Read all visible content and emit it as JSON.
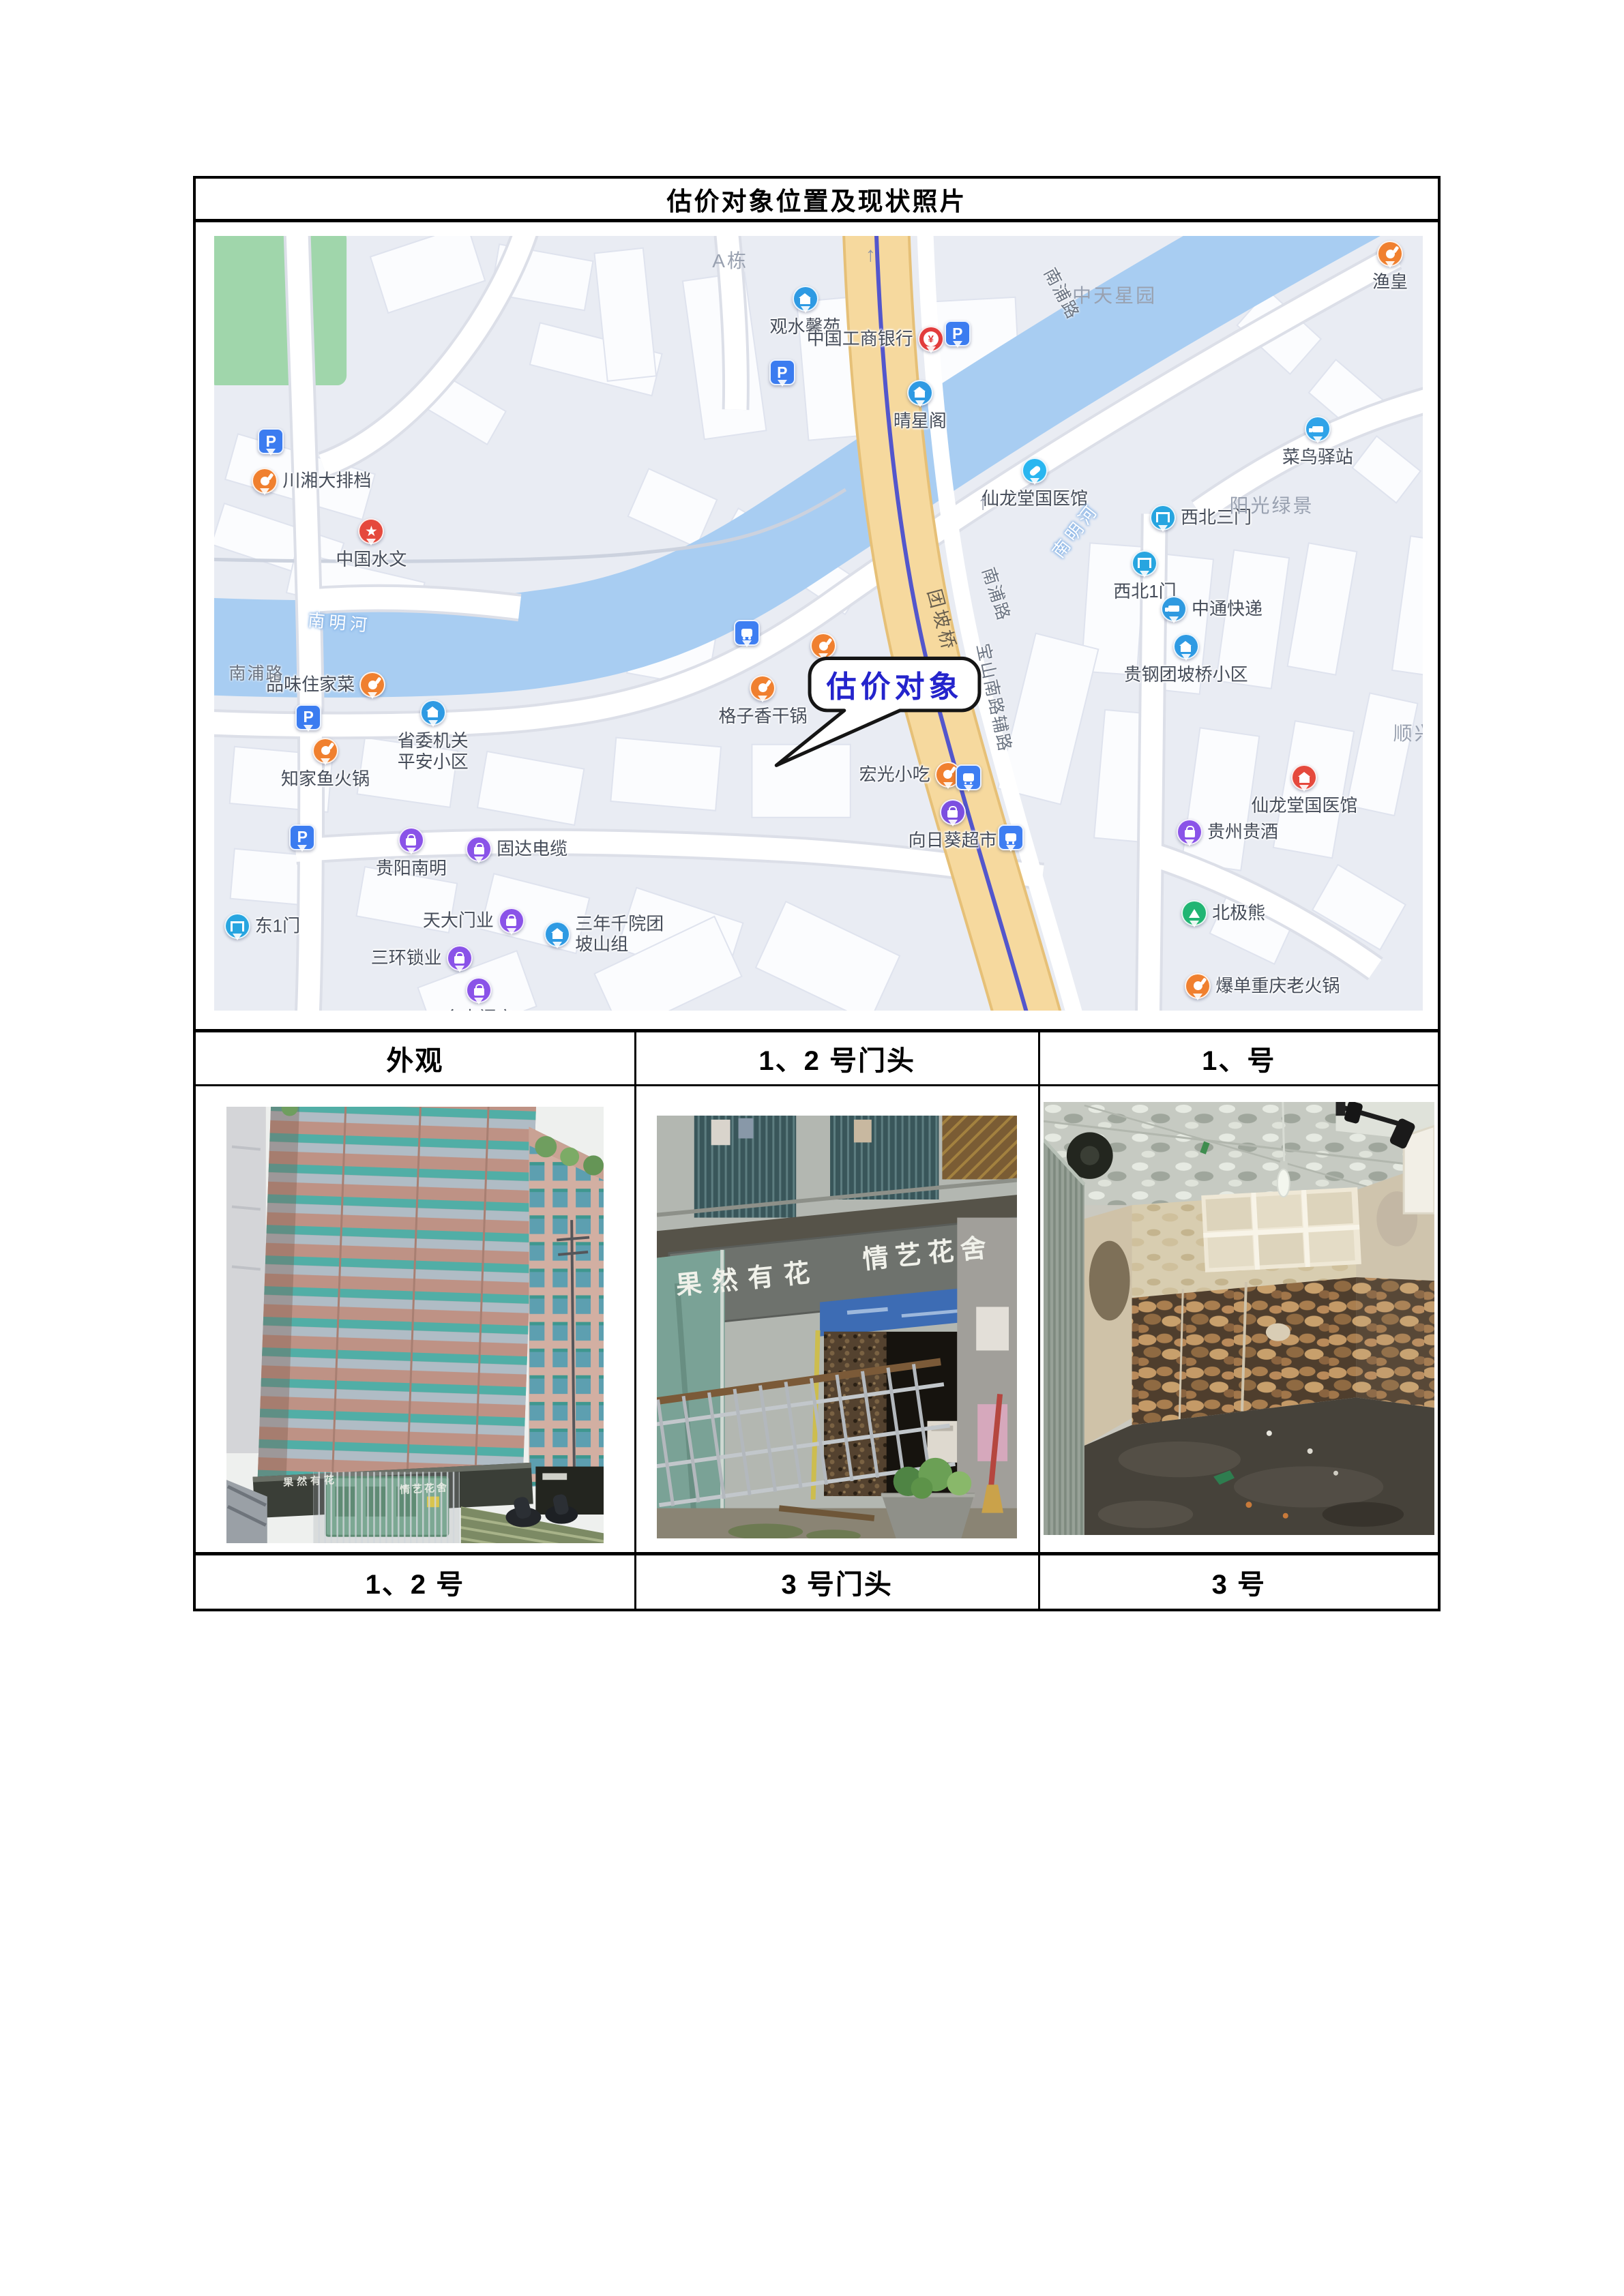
{
  "page": {
    "title": "估价对象位置及现状照片"
  },
  "table": {
    "header_row": [
      "外观",
      "1、2 号门头",
      "1、号"
    ],
    "footer_row": [
      "1、2 号",
      "3 号门头",
      "3 号"
    ]
  },
  "map": {
    "callout": {
      "text": "估价对象",
      "color": "#2424cc"
    },
    "colors": {
      "water": "#a8cdf2",
      "main_road": "#f6d99e",
      "park": "#a0d6ab",
      "background": "#e9ecf3",
      "metro_line": "#5356cc"
    },
    "area_labels": [
      {
        "text": "A栋",
        "x": 42.7,
        "y": 3.1
      },
      {
        "text": "中天星园",
        "x": 74.5,
        "y": 7.6
      },
      {
        "text": "阳光绿景",
        "x": 87.5,
        "y": 34.7
      },
      {
        "text": "顺兴",
        "x": 99.3,
        "y": 64.1
      }
    ],
    "road_labels": [
      {
        "text": "南浦路",
        "x": 3.5,
        "y": 56.3,
        "rot": 0,
        "style": "road"
      },
      {
        "text": "南浦路",
        "x": 70.2,
        "y": 7.4,
        "rot": 62,
        "style": "road"
      },
      {
        "text": "南浦路",
        "x": 64.8,
        "y": 46.2,
        "rot": 72,
        "style": "road"
      },
      {
        "text": "团坡桥",
        "x": 60.3,
        "y": 49.6,
        "rot": 75,
        "style": "main"
      },
      {
        "text": "宝山南路辅路",
        "x": 64.6,
        "y": 59.6,
        "rot": 78,
        "style": "road"
      },
      {
        "text": "南明河",
        "x": 10.4,
        "y": 49.8,
        "rot": 5,
        "style": "water"
      },
      {
        "text": "南明河",
        "x": 71.2,
        "y": 37.9,
        "rot": -52,
        "style": "water"
      }
    ],
    "arrows": [
      {
        "glyph": "↑",
        "x": 54.3,
        "y": 2.5,
        "rot": 0
      },
      {
        "glyph": "↑",
        "x": 63.6,
        "y": 34.5,
        "rot": 0
      },
      {
        "glyph": "↑",
        "x": 60.8,
        "y": 57.5,
        "rot": 180
      }
    ],
    "pois": [
      {
        "label": "",
        "icon": "parking",
        "color": "#3b7cf0",
        "x": 4.7,
        "y": 26.7,
        "lp": "r"
      },
      {
        "label": "川湘大排档",
        "icon": "food",
        "color": "#f0802f",
        "x": 4.2,
        "y": 31.8,
        "lp": "r"
      },
      {
        "label": "中国水文",
        "icon": "star",
        "color": "#e5493d",
        "x": 13.0,
        "y": 38.3,
        "lp": "b"
      },
      {
        "label": "品味住家菜",
        "icon": "food",
        "color": "#f0802f",
        "x": 13.1,
        "y": 58.1,
        "lp": "l"
      },
      {
        "label": "",
        "icon": "parking",
        "color": "#3b7cf0",
        "x": 7.8,
        "y": 62.3,
        "lp": "b"
      },
      {
        "label": "知家鱼火锅",
        "icon": "food",
        "color": "#f0802f",
        "x": 9.2,
        "y": 66.6,
        "lp": "b"
      },
      {
        "label": "省委机关\n平安小区",
        "icon": "building",
        "color": "#2e9ae3",
        "x": 18.1,
        "y": 61.7,
        "lp": "b"
      },
      {
        "label": "",
        "icon": "parking",
        "color": "#3b7cf0",
        "x": 7.3,
        "y": 77.8,
        "lp": "b"
      },
      {
        "label": "贵阳南明",
        "icon": "shop",
        "color": "#8a53e8",
        "x": 16.3,
        "y": 78.2,
        "lp": "b"
      },
      {
        "label": "固达电缆",
        "icon": "shop",
        "color": "#8a53e8",
        "x": 21.9,
        "y": 79.3,
        "lp": "r"
      },
      {
        "label": "东1门",
        "icon": "gate",
        "color": "#27a5e0",
        "x": 1.9,
        "y": 89.3,
        "lp": "r"
      },
      {
        "label": "天大门业",
        "icon": "shop",
        "color": "#8a53e8",
        "x": 24.6,
        "y": 88.6,
        "lp": "l"
      },
      {
        "label": "三环锁业",
        "icon": "shop",
        "color": "#8a53e8",
        "x": 20.3,
        "y": 93.4,
        "lp": "l"
      },
      {
        "label": "金丰门窗",
        "icon": "shop",
        "color": "#8a53e8",
        "x": 21.9,
        "y": 97.5,
        "lp": "b"
      },
      {
        "label": "三年千院团\n坡山组",
        "icon": "building",
        "color": "#2e9ae3",
        "x": 28.4,
        "y": 90.3,
        "lp": "r"
      },
      {
        "label": "观水馨苑",
        "icon": "building",
        "color": "#2e9ae3",
        "x": 48.9,
        "y": 8.3,
        "lp": "b"
      },
      {
        "label": "",
        "icon": "parking",
        "color": "#3b7cf0",
        "x": 47.0,
        "y": 17.8,
        "lp": "b"
      },
      {
        "label": "",
        "icon": "bus",
        "color": "#3e7ef2",
        "x": 44.1,
        "y": 51.4,
        "lp": "b"
      },
      {
        "label": "格子香干锅",
        "icon": "food",
        "color": "#f0802f",
        "x": 45.4,
        "y": 58.5,
        "lp": "b"
      },
      {
        "label": "",
        "icon": "food",
        "color": "#f0802f",
        "x": 50.4,
        "y": 53.1,
        "lp": "b"
      },
      {
        "label": "宏光小吃",
        "icon": "food",
        "color": "#f0802f",
        "x": 60.7,
        "y": 69.7,
        "lp": "l"
      },
      {
        "label": "",
        "icon": "bus",
        "color": "#3e7ef2",
        "x": 62.4,
        "y": 70.1,
        "lp": "b"
      },
      {
        "label": "向日葵超市",
        "icon": "cart",
        "color": "#7c4fe0",
        "x": 61.1,
        "y": 74.6,
        "lp": "b"
      },
      {
        "label": "",
        "icon": "bus",
        "color": "#3e7ef2",
        "x": 65.9,
        "y": 77.8,
        "lp": "b"
      },
      {
        "label": "中国工商银行",
        "icon": "bank",
        "color": "#e23c3c",
        "x": 59.3,
        "y": 13.5,
        "lp": "l"
      },
      {
        "label": "",
        "icon": "parking",
        "color": "#3b7cf0",
        "x": 61.5,
        "y": 12.8,
        "lp": "b"
      },
      {
        "label": "晴星阁",
        "icon": "building",
        "color": "#2e9ae3",
        "x": 58.4,
        "y": 20.4,
        "lp": "b"
      },
      {
        "label": "仙龙堂国医馆",
        "icon": "pill",
        "color": "#29b6f0",
        "x": 67.9,
        "y": 30.5,
        "lp": "b"
      },
      {
        "label": "渔皇",
        "icon": "food",
        "color": "#f0802f",
        "x": 97.3,
        "y": 2.5,
        "lp": "b"
      },
      {
        "label": "菜鸟驿站",
        "icon": "horn",
        "color": "#2fa3e8",
        "x": 91.3,
        "y": 25.1,
        "lp": "b"
      },
      {
        "label": "西北三门",
        "icon": "gate",
        "color": "#27a5e0",
        "x": 78.5,
        "y": 36.5,
        "lp": "r"
      },
      {
        "label": "西北1门",
        "icon": "gate",
        "color": "#27a5e0",
        "x": 77.0,
        "y": 42.4,
        "lp": "b"
      },
      {
        "label": "中通快递",
        "icon": "truck",
        "color": "#2f9ae0",
        "x": 79.4,
        "y": 48.3,
        "lp": "r"
      },
      {
        "label": "贵钢团坡桥小区",
        "icon": "building",
        "color": "#2e9ae3",
        "x": 80.4,
        "y": 53.2,
        "lp": "b"
      },
      {
        "label": "仙龙堂国医馆",
        "icon": "med",
        "color": "#e5493d",
        "x": 90.2,
        "y": 70.1,
        "lp": "b"
      },
      {
        "label": "贵州贵酒",
        "icon": "shop",
        "color": "#8a53e8",
        "x": 80.7,
        "y": 77.1,
        "lp": "r"
      },
      {
        "label": "北极熊",
        "icon": "tree",
        "color": "#21b573",
        "x": 81.1,
        "y": 87.6,
        "lp": "r"
      },
      {
        "label": "爆单重庆老火锅",
        "icon": "food",
        "color": "#f0802f",
        "x": 81.4,
        "y": 97.0,
        "lp": "r"
      }
    ]
  },
  "photos": {
    "storefront_sign": {
      "left": "果然有花",
      "right": "情艺花舍"
    }
  }
}
